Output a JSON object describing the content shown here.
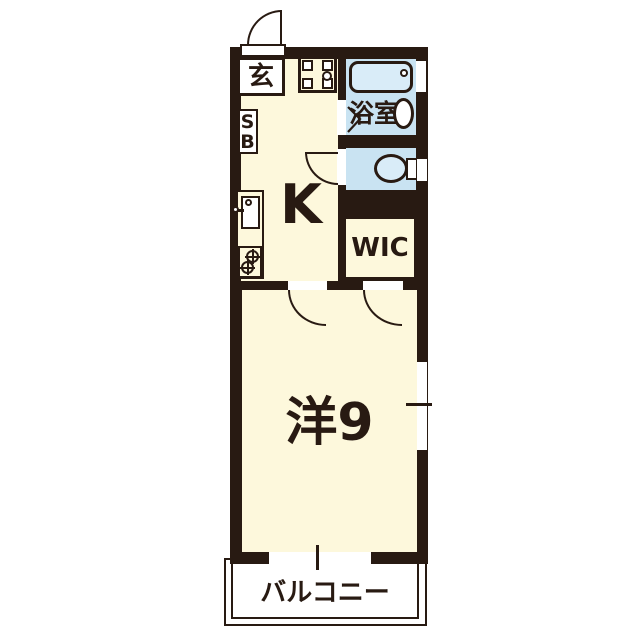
{
  "floorplan": {
    "rooms": {
      "entrance": {
        "label": "玄"
      },
      "shoe_box": {
        "label": "SB"
      },
      "kitchen": {
        "label": "K"
      },
      "bathroom": {
        "label": "浴室"
      },
      "walk_in_closet": {
        "label": "WIC"
      },
      "western_room": {
        "label": "洋9"
      },
      "balcony": {
        "label": "バルコニー"
      }
    },
    "colors": {
      "wall": "#281a12",
      "floor_cream": "#fdf8dc",
      "wet_area_blue": "#c9e3f2",
      "fixture_white": "#ffffff"
    }
  }
}
